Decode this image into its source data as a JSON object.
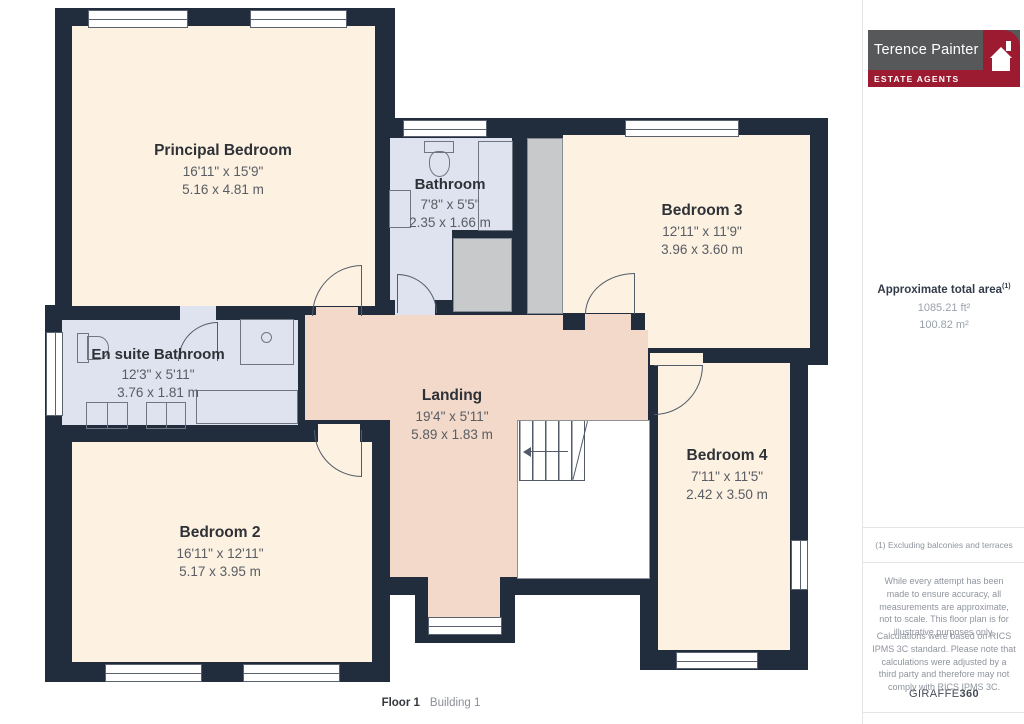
{
  "rooms": {
    "principal_bedroom": {
      "name": "Principal Bedroom",
      "imperial": "16'11\" x 15'9\"",
      "metric": "5.16 x 4.81 m"
    },
    "bathroom": {
      "name": "Bathroom",
      "imperial": "7'8\" x 5'5\"",
      "metric": "2.35 x 1.66 m"
    },
    "bedroom_3": {
      "name": "Bedroom 3",
      "imperial": "12'11\" x 11'9\"",
      "metric": "3.96 x 3.60 m"
    },
    "en_suite_bathroom": {
      "name": "En suite Bathroom",
      "imperial": "12'3\" x 5'11\"",
      "metric": "3.76 x 1.81 m"
    },
    "landing": {
      "name": "Landing",
      "imperial": "19'4\" x 5'11\"",
      "metric": "5.89 x 1.83 m"
    },
    "bedroom_2": {
      "name": "Bedroom 2",
      "imperial": "16'11\" x 12'11\"",
      "metric": "5.17 x 3.95 m"
    },
    "bedroom_4": {
      "name": "Bedroom 4",
      "imperial": "7'11\" x 11'5\"",
      "metric": "2.42 x 3.50 m"
    }
  },
  "floor_label": {
    "floor": "Floor 1",
    "building": "Building 1"
  },
  "sidebar": {
    "logo": {
      "name": "Terence Painter",
      "tagline": "ESTATE AGENTS"
    },
    "area": {
      "title": "Approximate total area",
      "superscript": "(1)",
      "value_ft": "1085.21 ft²",
      "value_m": "100.82 m²"
    },
    "footnote": "(1) Excluding balconies and terraces",
    "disclaimer_accuracy": "While every attempt has been made to ensure accuracy, all measurements are approximate, not to scale. This floor plan is for illustrative purposes only.",
    "disclaimer_calculations": "Calculations were based on RICS IPMS 3C standard. Please note that calculations were adjusted by a third party and therefore may not comply with RICS IPMS 3C.",
    "brand": {
      "name": "GIRAFFE",
      "suffix": "360"
    }
  },
  "colors": {
    "wall": "#212c3d",
    "bedroom_fill": "#fdf1e2",
    "bathroom_fill": "#dee3ef",
    "landing_fill": "#f2d9ca",
    "closet_fill": "#c8c9cb",
    "logo_gray": "#57585a",
    "logo_red": "#9c1b30",
    "accent_text": "#333c4b"
  }
}
